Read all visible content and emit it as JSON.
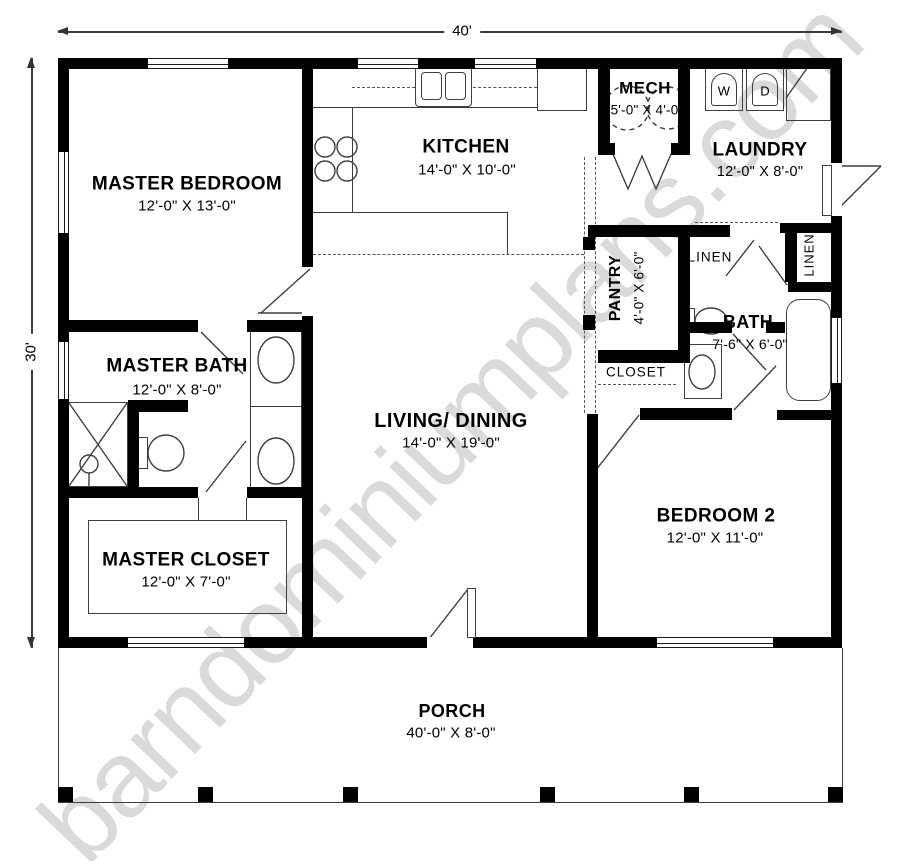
{
  "watermark": {
    "text": "barndominiumplans.com"
  },
  "overall_dimensions": {
    "width_label": "40'",
    "depth_label": "30'"
  },
  "rooms": {
    "master_bedroom": {
      "name": "MASTER BEDROOM",
      "dims": "12'-0\" X 13'-0\""
    },
    "kitchen": {
      "name": "KITCHEN",
      "dims": "14'-0\" X 10'-0\""
    },
    "mech": {
      "name": "MECH",
      "dims": "5'-0\" X 4'-0\""
    },
    "laundry": {
      "name": "LAUNDRY",
      "dims": "12'-0\" X 8'-0\""
    },
    "pantry": {
      "name": "PANTRY",
      "dims": "4'-0\" X 6'-0\""
    },
    "linen_hall": {
      "name": "LINEN"
    },
    "linen_right": {
      "name": "LINEN"
    },
    "bath": {
      "name": "BATH",
      "dims": "7'-6\" X 6'-0\""
    },
    "closet": {
      "name": "CLOSET"
    },
    "master_bath": {
      "name": "MASTER BATH",
      "dims": "12'-0\" X 8'-0\""
    },
    "living_dining": {
      "name": "LIVING/ DINING",
      "dims": "14'-0\" X 19'-0\""
    },
    "bedroom_2": {
      "name": "BEDROOM 2",
      "dims": "12'-0\" X 11'-0\""
    },
    "master_closet": {
      "name": "MASTER CLOSET",
      "dims": "12'-0\" X 7'-0\""
    },
    "porch": {
      "name": "PORCH",
      "dims": "40'-0\" X 8'-0\""
    }
  },
  "appliances": {
    "washer": "W",
    "dryer": "D"
  },
  "colors": {
    "wall": "#000000",
    "line": "#3c3c3c",
    "watermark": "#dadada"
  }
}
